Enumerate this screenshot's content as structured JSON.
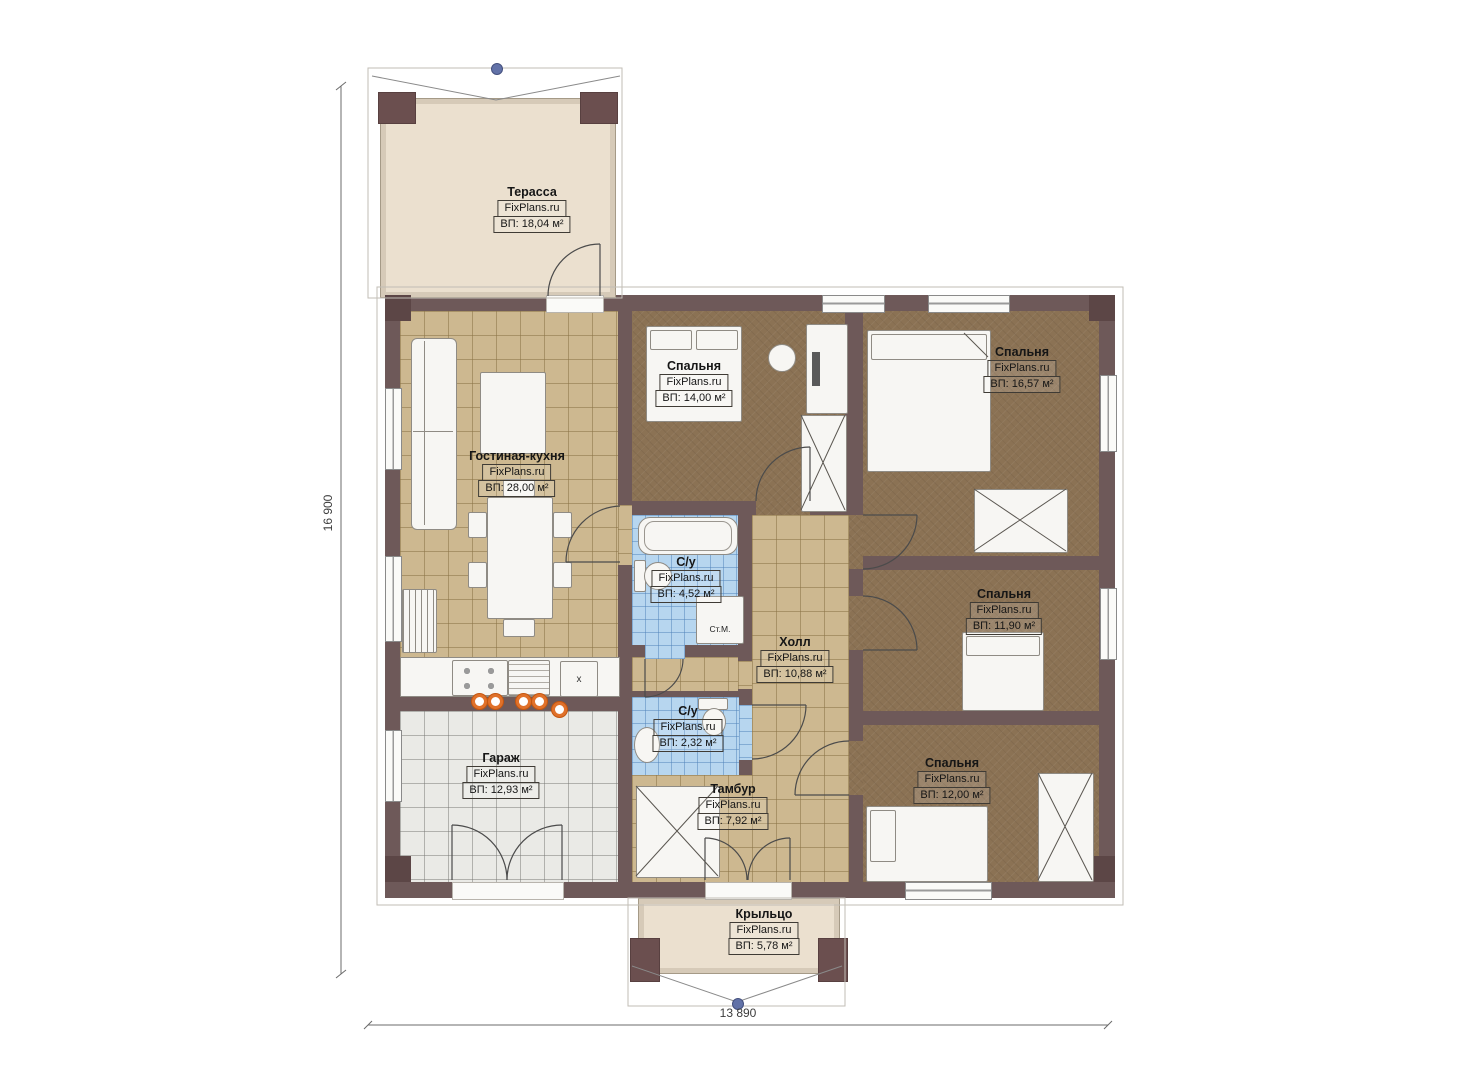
{
  "plan": {
    "brand": "FixPlans.ru",
    "dimensions": {
      "height_label": "16 900",
      "width_label": "13 890"
    },
    "rooms": [
      {
        "id": "terrace",
        "name": "Терасса",
        "watermark": "FixPlans.ru",
        "area": "ВП: 18,04 м²"
      },
      {
        "id": "living-kitchen",
        "name": "Гостиная-кухня",
        "watermark": "FixPlans.ru",
        "area": "ВП: 28,00 м²"
      },
      {
        "id": "bedroom-14",
        "name": "Спальня",
        "watermark": "FixPlans.ru",
        "area": "ВП: 14,00 м²"
      },
      {
        "id": "bedroom-1657",
        "name": "Спальня",
        "watermark": "FixPlans.ru",
        "area": "ВП: 16,57 м²"
      },
      {
        "id": "bathroom-452",
        "name": "С/у",
        "watermark": "FixPlans.ru",
        "area": "ВП: 4,52 м²"
      },
      {
        "id": "hall",
        "name": "Холл",
        "watermark": "FixPlans.ru",
        "area": "ВП: 10,88 м²"
      },
      {
        "id": "bedroom-1190",
        "name": "Спальня",
        "watermark": "FixPlans.ru",
        "area": "ВП: 11,90 м²"
      },
      {
        "id": "bathroom-232",
        "name": "С/у",
        "watermark": "FixPlans.ru",
        "area": "ВП: 2,32 м²"
      },
      {
        "id": "garage",
        "name": "Гараж",
        "watermark": "FixPlans.ru",
        "area": "ВП: 12,93 м²"
      },
      {
        "id": "tambour",
        "name": "Тамбур",
        "watermark": "FixPlans.ru",
        "area": "ВП: 7,92 м²"
      },
      {
        "id": "bedroom-1200",
        "name": "Спальня",
        "watermark": "FixPlans.ru",
        "area": "ВП: 12,00 м²"
      },
      {
        "id": "porch",
        "name": "Крыльцо",
        "watermark": "FixPlans.ru",
        "area": "ВП: 5,78 м²"
      }
    ],
    "annotations": {
      "washing_machine": "Ст.М.",
      "sink_marker": "x"
    },
    "colors": {
      "wall": "#6e5959",
      "living_floor": "#cdb890",
      "bedroom_floor": "#8b7254",
      "bath_floor": "#b7d6ef",
      "deck_floor": "#ebe0cf",
      "garage_floor": "#eaeae6",
      "burner_accent": "#e0712a",
      "grip_dot": "#6272a8"
    }
  }
}
